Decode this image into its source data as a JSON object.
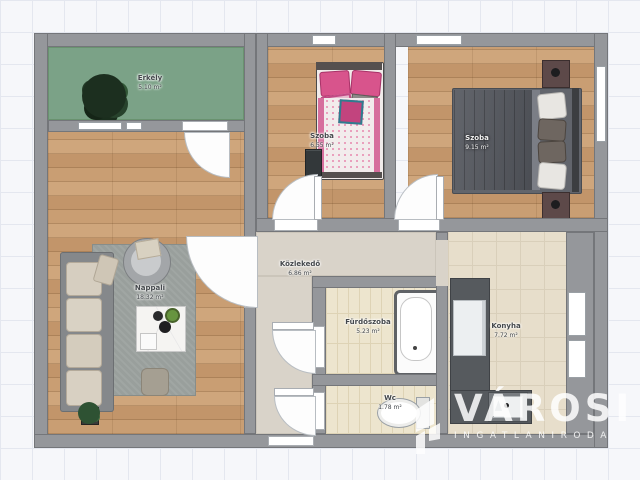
{
  "app": {
    "type": "floor-plan-viewer",
    "background": "grid-paper"
  },
  "rooms": [
    {
      "id": "erkely",
      "name": "Erkély",
      "area": "5.10 m²",
      "floor": "balcony-green"
    },
    {
      "id": "szoba-kicsi",
      "name": "Szoba",
      "area": "6.55 m²",
      "floor": "wood"
    },
    {
      "id": "szoba-nagy",
      "name": "Szoba",
      "area": "9.15 m²",
      "floor": "wood"
    },
    {
      "id": "nappali",
      "name": "Nappali",
      "area": "18.32 m²",
      "floor": "wood"
    },
    {
      "id": "kozlekedo",
      "name": "Közlekedő",
      "area": "6.86 m²",
      "floor": "screed"
    },
    {
      "id": "furdoszoba",
      "name": "Fürdőszoba",
      "area": "5.23 m²",
      "floor": "tile"
    },
    {
      "id": "konyha",
      "name": "Konyha",
      "area": "7.72 m²",
      "floor": "tile"
    },
    {
      "id": "wc",
      "name": "Wc",
      "area": "1.78 m²",
      "floor": "tile"
    }
  ],
  "furniture": [
    {
      "name": "tree",
      "room": "erkely"
    },
    {
      "name": "corner-sofa",
      "room": "nappali"
    },
    {
      "name": "round-armchair",
      "room": "nappali"
    },
    {
      "name": "rug",
      "room": "nappali"
    },
    {
      "name": "coffee-table",
      "room": "nappali"
    },
    {
      "name": "pouf",
      "room": "nappali"
    },
    {
      "name": "potted-plant",
      "room": "nappali"
    },
    {
      "name": "single-bed-pink",
      "room": "szoba-kicsi"
    },
    {
      "name": "nightstand",
      "room": "szoba-kicsi"
    },
    {
      "name": "double-bed",
      "room": "szoba-nagy"
    },
    {
      "name": "nightstand",
      "room": "szoba-nagy"
    },
    {
      "name": "nightstand",
      "room": "szoba-nagy"
    },
    {
      "name": "bathtub",
      "room": "furdoszoba"
    },
    {
      "name": "toilet",
      "room": "wc"
    },
    {
      "name": "l-shaped-counter",
      "room": "konyha"
    },
    {
      "name": "sink",
      "room": "konyha"
    },
    {
      "name": "fridge",
      "room": "konyha"
    }
  ],
  "colors": {
    "wall": "#95979b",
    "wood": "#c99e73",
    "balcony": "#7ba287",
    "corridor": "#d9d3c9",
    "bath_tile": "#ede5ce",
    "kitchen_tile": "#e7decb",
    "accent_pink": "#d6568e",
    "watermark": "#ffffff"
  },
  "watermark": {
    "brand": "VÁROSI",
    "tagline": "INGATLANIRODA",
    "logo": "varosi-building-logo"
  }
}
